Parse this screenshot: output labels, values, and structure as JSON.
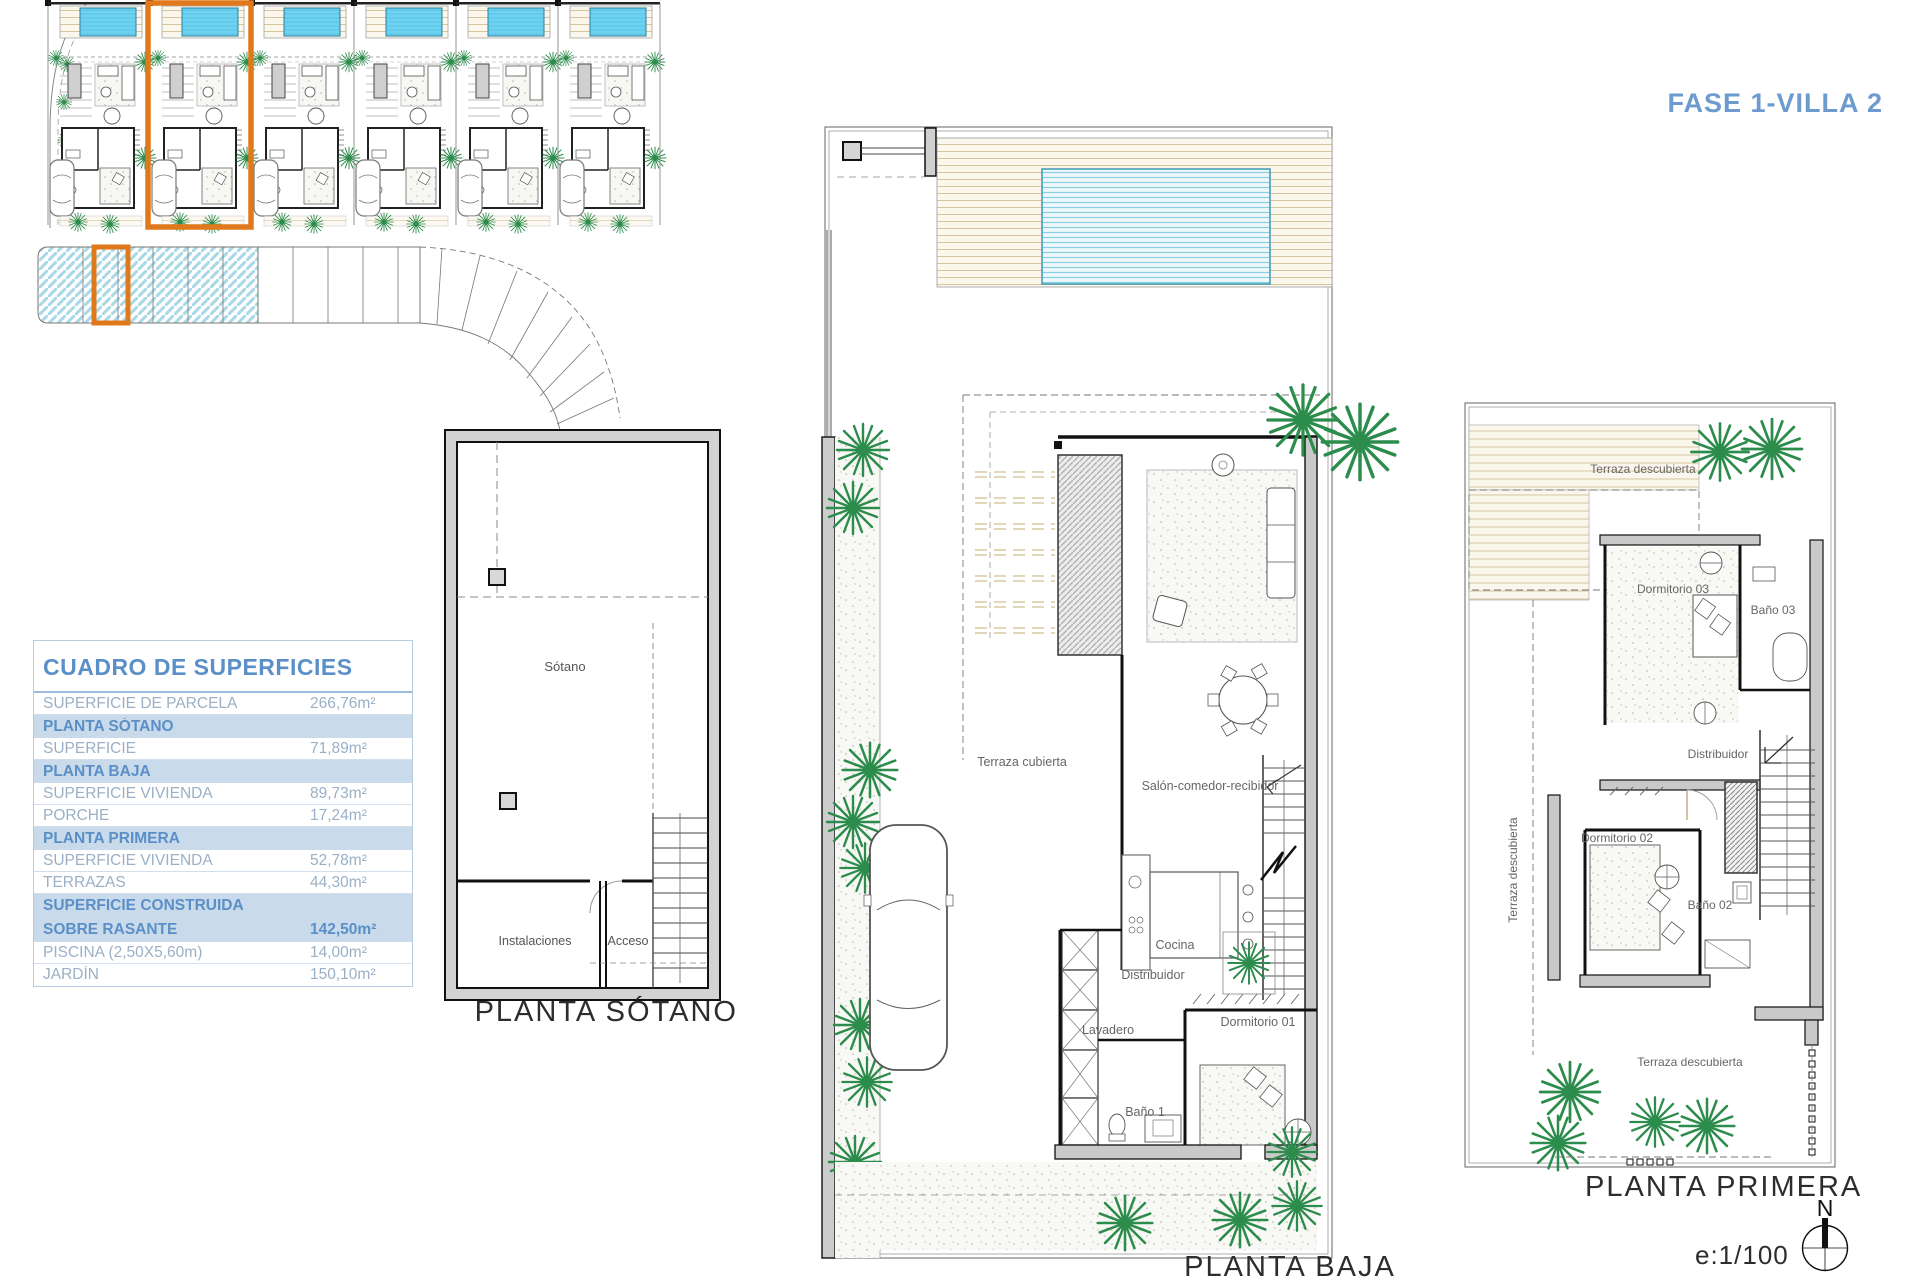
{
  "header": {
    "title": "FASE 1-VILLA 2"
  },
  "surfaces_table": {
    "title": "CUADRO DE SUPERFICIES",
    "rows": [
      {
        "label": "SUPERFICIE DE PARCELA",
        "value": "266,76m²",
        "type": "data"
      },
      {
        "label": "PLANTA SÓTANO",
        "value": "",
        "type": "section"
      },
      {
        "label": "SUPERFICIE",
        "value": "71,89m²",
        "type": "data"
      },
      {
        "label": "PLANTA BAJA",
        "value": "",
        "type": "section"
      },
      {
        "label": "SUPERFICIE VIVIENDA",
        "value": "89,73m²",
        "type": "data"
      },
      {
        "label": "PORCHE",
        "value": "17,24m²",
        "type": "data"
      },
      {
        "label": "PLANTA PRIMERA",
        "value": "",
        "type": "section"
      },
      {
        "label": "SUPERFICIE VIVIENDA",
        "value": "52,78m²",
        "type": "data"
      },
      {
        "label": "TERRAZAS",
        "value": "44,30m²",
        "type": "data"
      },
      {
        "label": "SUPERFICIE CONSTRUIDA",
        "value": "",
        "type": "section"
      },
      {
        "label": "SOBRE RASANTE",
        "value": "142,50m²",
        "type": "section-bold"
      },
      {
        "label": "PISCINA (2,50X5,60m)",
        "value": "14,00m²",
        "type": "data"
      },
      {
        "label": "JARDÍN",
        "value": "150,10m²",
        "type": "data"
      }
    ]
  },
  "plans": {
    "sotano": {
      "title": "PLANTA SÓTANO",
      "rooms": {
        "sotano": "Sótano",
        "instalaciones": "Instalaciones",
        "acceso": "Acceso"
      }
    },
    "baja": {
      "title": "PLANTA BAJA",
      "rooms": {
        "terraza_cubierta": "Terraza cubierta",
        "salon": "Salón-comedor-recibidor",
        "cocina": "Cocina",
        "distribuidor": "Distribuidor",
        "lavadero": "Lavadero",
        "dormitorio_01": "Dormitorio 01",
        "bano_1": "Baño 1"
      }
    },
    "primera": {
      "title": "PLANTA PRIMERA",
      "rooms": {
        "terraza_top": "Terraza descubierta",
        "terraza_left": "Terraza descubierta",
        "terraza_bottom": "Terraza descubierta",
        "dormitorio_03": "Dormitorio 03",
        "bano_03": "Baño 03",
        "distribuidor": "Distribuidor",
        "dormitorio_02": "Dormitorio 02",
        "bano_02": "Baño 02"
      }
    }
  },
  "footer": {
    "scale": "e:1/100",
    "north": "N"
  },
  "colors": {
    "accent_orange": "#e0791b",
    "heading_blue": "#5a8fc7",
    "pool_cyan": "#6fd2f0",
    "tree_green": "#2c8c4b",
    "section_row_bg": "#c9daeb"
  }
}
